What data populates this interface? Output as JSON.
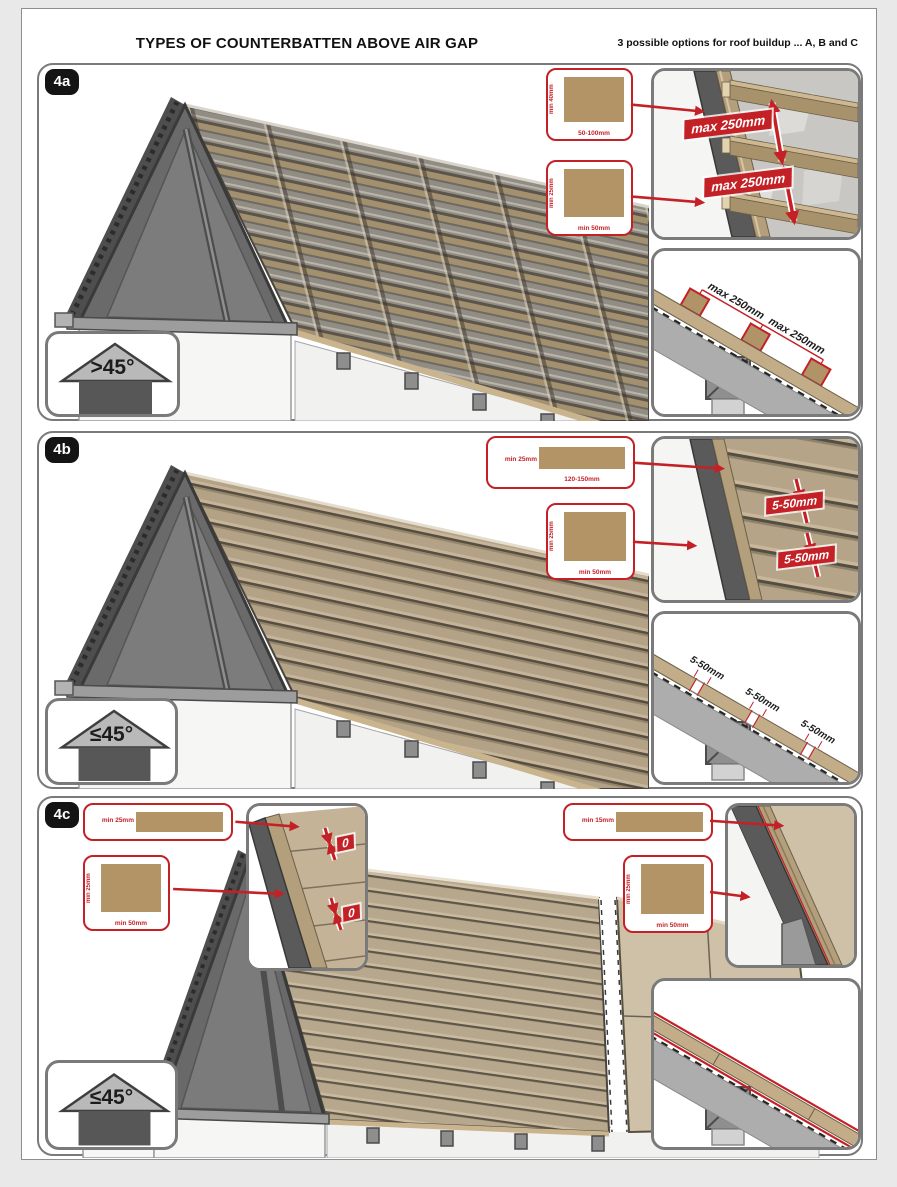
{
  "header": {
    "title": "TYPES OF COUNTERBATTEN ABOVE AIR GAP",
    "note": "3 possible options for roof buildup ... A, B and C"
  },
  "colors": {
    "accent_red": "#c42127",
    "wood": "#b29467",
    "panel_border": "#7a7a7a"
  },
  "p4a": {
    "id": "4a",
    "angle": ">45°",
    "c1_side": "min 40mm",
    "c1_bottom": "50-100mm",
    "c2_side": "min 25mm",
    "c2_bottom": "min 50mm",
    "top_label1": "max 250mm",
    "top_label2": "max 250mm",
    "bot_label1": "max 250mm",
    "bot_label2": "max 250mm"
  },
  "p4b": {
    "id": "4b",
    "angle": "≤45°",
    "c1_side": "min 25mm",
    "c1_bottom": "120-150mm",
    "c2_side": "min 25mm",
    "c2_bottom": "min 50mm",
    "top_label1": "5-50mm",
    "top_label2": "5-50mm",
    "bot_label1": "5-50mm",
    "bot_label2": "5-50mm",
    "bot_label3": "5-50mm"
  },
  "p4c": {
    "id": "4c",
    "angle": "≤45°",
    "cl1_side": "min 25mm",
    "cl2_side": "min 25mm",
    "cl2_bottom": "min 50mm",
    "cr1_side": "min 15mm",
    "cr2_side": "min 25mm",
    "cr2_bottom": "min 50mm",
    "gap1": "0",
    "gap2": "0"
  }
}
